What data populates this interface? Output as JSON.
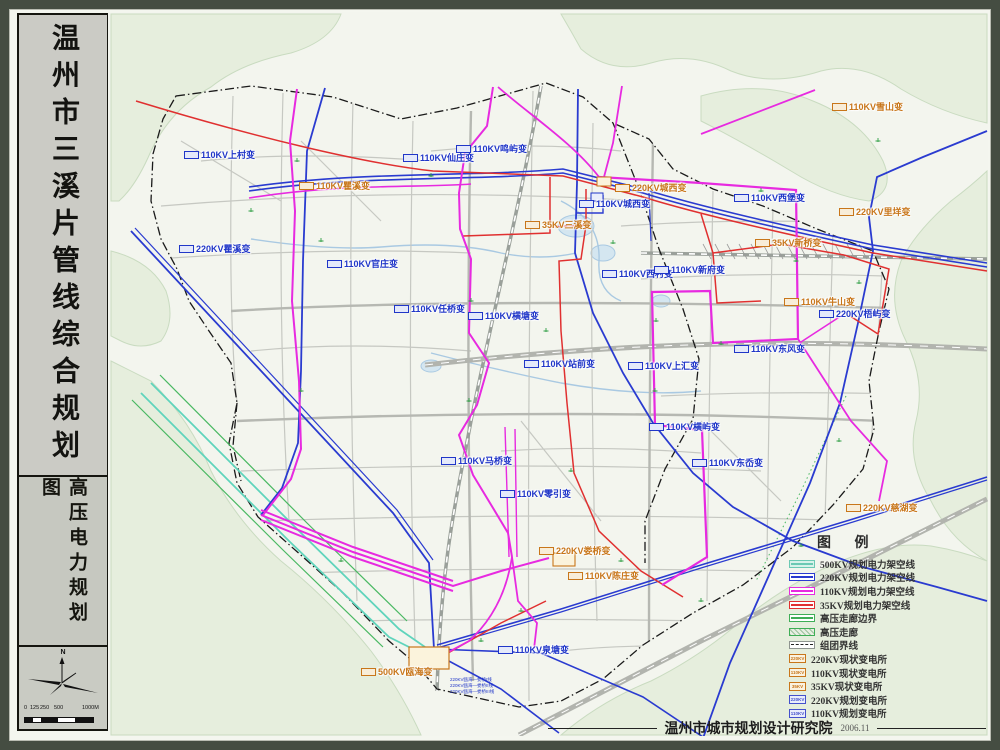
{
  "sidebar": {
    "title": "温州市三溪片管线综合规划",
    "subtitle": "高压电力规划图",
    "compass": "N",
    "scale_labels": [
      {
        "text": "0",
        "x": 0
      },
      {
        "text": "125",
        "x": 6
      },
      {
        "text": "250",
        "x": 16
      },
      {
        "text": "500",
        "x": 30
      },
      {
        "text": "1000M",
        "x": 58
      }
    ]
  },
  "legend": {
    "title": "图 例",
    "line_items": [
      {
        "label": "500KV规划电力架空线",
        "color": "#6cc9b4",
        "swatch_bg": "#d8f2ea",
        "style": "line"
      },
      {
        "label": "220KV规划电力架空线",
        "color": "#2a3bd0",
        "swatch_bg": "#ffffff",
        "style": "line"
      },
      {
        "label": "110KV规划电力架空线",
        "color": "#e72ae0",
        "swatch_bg": "#ffffff",
        "style": "line"
      },
      {
        "label": "35KV规划电力架空线",
        "color": "#e03030",
        "swatch_bg": "#ffffff",
        "style": "line"
      },
      {
        "label": "高压走廊边界",
        "color": "#3fae56",
        "swatch_bg": "#ffffff",
        "style": "line"
      },
      {
        "label": "高压走廊",
        "color": "#3fae56",
        "swatch_bg": "#e3ecdc",
        "style": "hatch"
      },
      {
        "label": "组团界线",
        "color": "#222222",
        "swatch_bg": "#ffffff",
        "style": "dashdot"
      }
    ],
    "station_items": [
      {
        "box_text": "220KV",
        "label": "220KV现状变电所",
        "style": "existing"
      },
      {
        "box_text": "110KV",
        "label": "110KV现状变电所",
        "style": "existing"
      },
      {
        "box_text": "35KV",
        "label": "35KV现状变电所",
        "style": "existing"
      },
      {
        "box_text": "220KV",
        "label": "220KV规划变电所",
        "style": "planned"
      },
      {
        "box_text": "110KV",
        "label": "110KV规划变电所",
        "style": "planned"
      }
    ]
  },
  "map": {
    "existing_color": "#c8761a",
    "planned_color": "#2036c8",
    "substations": [
      {
        "name": "110KV上村变",
        "type": "planned",
        "x": 183,
        "y": 152
      },
      {
        "name": "110KV仙庄变",
        "type": "planned",
        "x": 402,
        "y": 155
      },
      {
        "name": "110KV鸣屿变",
        "type": "planned",
        "x": 455,
        "y": 146
      },
      {
        "name": "110KV瞿溪变",
        "type": "existing",
        "x": 298,
        "y": 183
      },
      {
        "name": "220KV瞿溪变",
        "type": "planned",
        "x": 178,
        "y": 246
      },
      {
        "name": "110KV官庄变",
        "type": "planned",
        "x": 326,
        "y": 261
      },
      {
        "name": "220KV城西变",
        "type": "existing",
        "x": 614,
        "y": 185
      },
      {
        "name": "110KV城西变",
        "type": "planned",
        "x": 578,
        "y": 201
      },
      {
        "name": "35KV三溪变",
        "type": "existing",
        "x": 524,
        "y": 222
      },
      {
        "name": "110KV西村变",
        "type": "planned",
        "x": 601,
        "y": 271
      },
      {
        "name": "110KV新府变",
        "type": "planned",
        "x": 653,
        "y": 267
      },
      {
        "name": "110KV雪山变",
        "type": "existing",
        "x": 831,
        "y": 104
      },
      {
        "name": "110KV西堡变",
        "type": "planned",
        "x": 733,
        "y": 195
      },
      {
        "name": "220KV里垟变",
        "type": "existing",
        "x": 838,
        "y": 209
      },
      {
        "name": "35KV新桥变",
        "type": "existing",
        "x": 754,
        "y": 240
      },
      {
        "name": "110KV牛山变",
        "type": "existing",
        "x": 783,
        "y": 299
      },
      {
        "name": "220KV梧屿变",
        "type": "planned",
        "x": 818,
        "y": 311
      },
      {
        "name": "110KV任桥变",
        "type": "planned",
        "x": 393,
        "y": 306
      },
      {
        "name": "110KV横塘变",
        "type": "planned",
        "x": 467,
        "y": 313
      },
      {
        "name": "110KV站前变",
        "type": "planned",
        "x": 523,
        "y": 361
      },
      {
        "name": "110KV上汇变",
        "type": "planned",
        "x": 627,
        "y": 363
      },
      {
        "name": "110KV东风变",
        "type": "planned",
        "x": 733,
        "y": 346
      },
      {
        "name": "110KV横屿变",
        "type": "planned",
        "x": 648,
        "y": 424
      },
      {
        "name": "110KV马桥变",
        "type": "planned",
        "x": 440,
        "y": 458
      },
      {
        "name": "110KV东岙变",
        "type": "planned",
        "x": 691,
        "y": 460
      },
      {
        "name": "110KV零引变",
        "type": "planned",
        "x": 499,
        "y": 491
      },
      {
        "name": "220KV娄桥变",
        "type": "existing",
        "x": 538,
        "y": 548
      },
      {
        "name": "110KV陈庄变",
        "type": "existing",
        "x": 567,
        "y": 573
      },
      {
        "name": "110KV泉塘变",
        "type": "planned",
        "x": 497,
        "y": 647
      },
      {
        "name": "500KV瓯海变",
        "type": "existing",
        "x": 360,
        "y": 669
      },
      {
        "name": "220KV慈湖变",
        "type": "existing",
        "x": 845,
        "y": 505
      }
    ],
    "route_labels": [
      {
        "text": "220KV瓯海—娄桥I线",
        "x": 449,
        "y": 676
      },
      {
        "text": "220KV瓯海—娄桥II线",
        "x": 449,
        "y": 682
      },
      {
        "text": "220KV瓯海—娄桥III线",
        "x": 449,
        "y": 688
      }
    ]
  },
  "footer": {
    "org": "温州市城市规划设计研究院",
    "date": "2006.11"
  }
}
